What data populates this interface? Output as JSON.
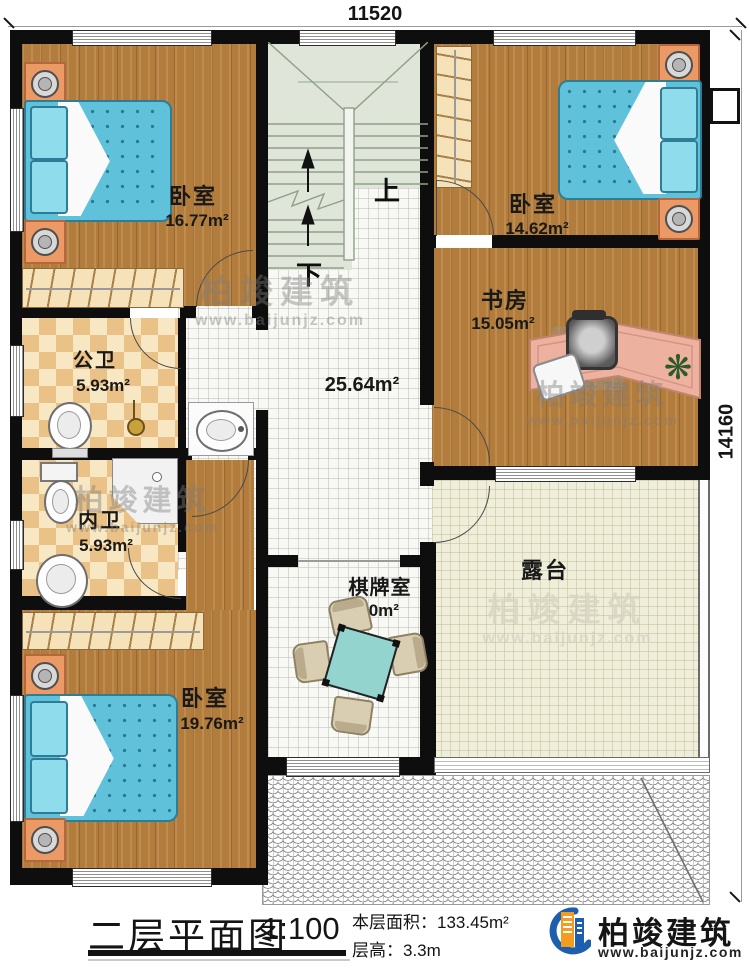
{
  "dimensions": {
    "top": "11520",
    "right": "14160"
  },
  "stairs": {
    "up": "上",
    "down": "下"
  },
  "rooms": {
    "b1": {
      "name": "卧室",
      "area": "16.77m²"
    },
    "b2": {
      "name": "卧室",
      "area": "14.62m²"
    },
    "study": {
      "name": "书房",
      "area": "15.05m²"
    },
    "pubbath": {
      "name": "公卫",
      "area": "5.93m²"
    },
    "innerbath": {
      "name": "内卫",
      "area": "5.93m²"
    },
    "b3": {
      "name": "卧室",
      "area": "19.76m²"
    },
    "chess": {
      "name": "棋牌室",
      "area": "8.60m²"
    },
    "terrace": {
      "name": "露台"
    },
    "hall": {
      "area": "25.64m²"
    }
  },
  "title_block": {
    "title": "二层平面图",
    "scale": "1:100",
    "floor_area": "本层面积：133.45m²",
    "floor_height": "层高：3.3m"
  },
  "brand": {
    "name": "柏竣建筑",
    "site": "www.baijunjz.com"
  },
  "colors": {
    "wall": "#0e0e0e",
    "wood": "#b27c3c",
    "bed": "#5fc2da",
    "brand_blue": "#1d5fae",
    "brand_orange": "#f39c1f"
  }
}
